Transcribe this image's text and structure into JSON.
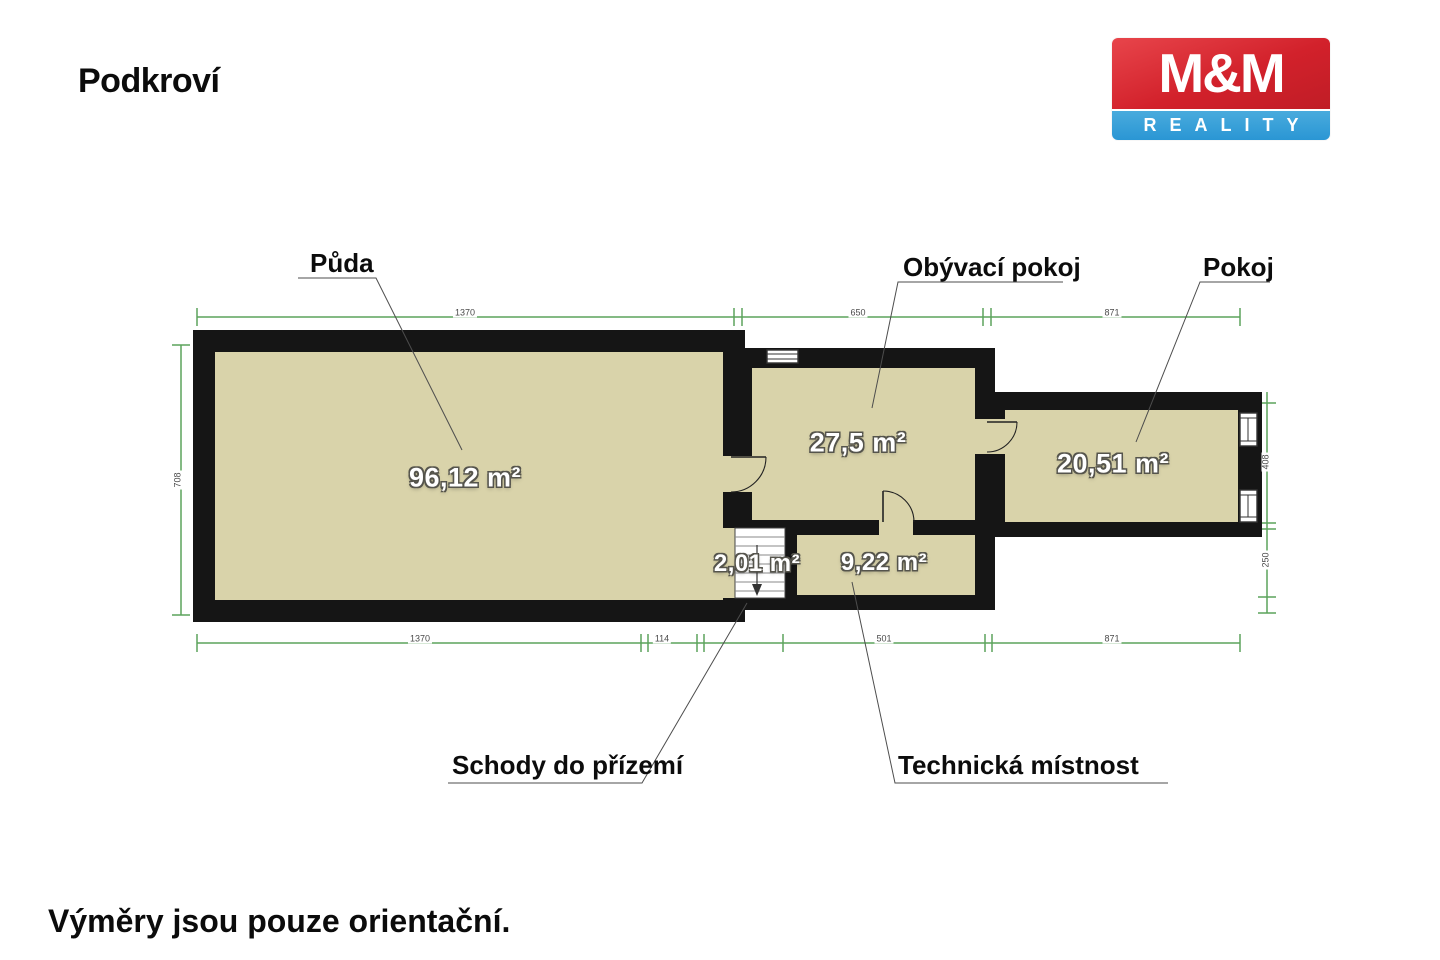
{
  "page": {
    "title": "Podkroví",
    "footnote": "Výměry jsou pouze orientační."
  },
  "logo": {
    "top": "M&M",
    "bottom": "REALITY",
    "red": "#d2212b",
    "blue": "#2a96d4"
  },
  "rooms": {
    "puda": {
      "label": "Půda",
      "area": "96,12 m²"
    },
    "obyvaci": {
      "label": "Obývací pokoj",
      "area": "27,5 m²"
    },
    "pokoj": {
      "label": "Pokoj",
      "area": "20,51 m²"
    },
    "schody": {
      "label": "Schody do přízemí",
      "area": "2,01 m²"
    },
    "technicka": {
      "label": "Technická místnost",
      "area": "9,22 m²"
    }
  },
  "dimensions": {
    "top": [
      "1370",
      "650",
      "871"
    ],
    "bottom": [
      "1370",
      "114",
      "501",
      "871"
    ],
    "left": [
      "708"
    ],
    "right": [
      "408",
      "250"
    ]
  },
  "colors": {
    "wall": "#151515",
    "floor": "#d9d3aa",
    "dimension_green": "#5ca35c",
    "leader_gray": "#4d4d4d"
  }
}
